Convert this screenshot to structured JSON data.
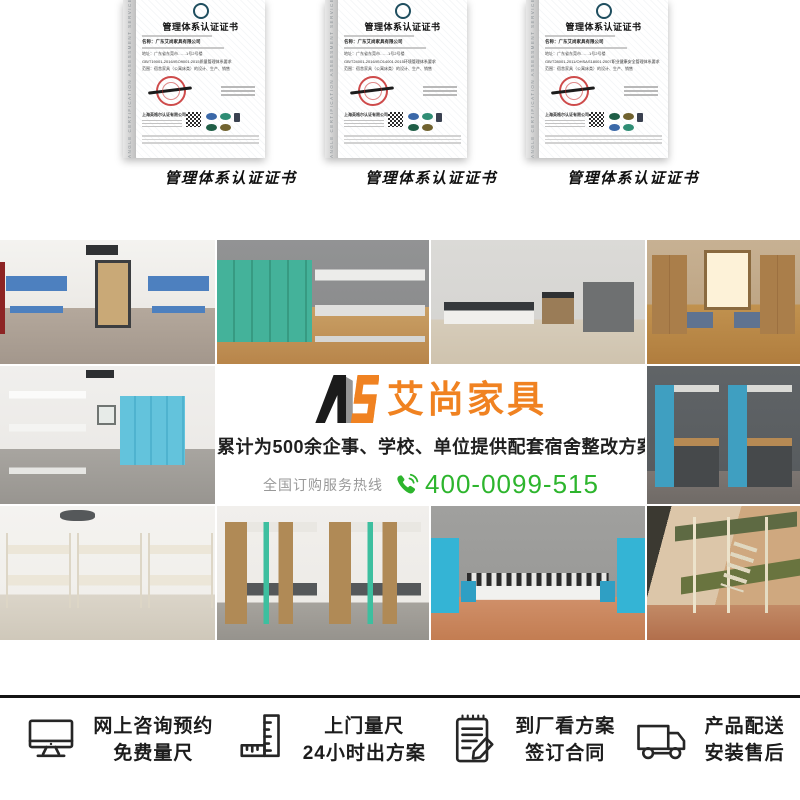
{
  "certificates": {
    "watermark": "ANGLE CERTIFICATION ASSESSMENT SERVICES",
    "cert": {
      "title": "管理体系认证证书",
      "company": "名称：广东艾尚家具有限公司",
      "address": "地址：广东省东莞市……1号2号楼",
      "scope": "范围：宿舍家具（公寓床类）的设计、生产、销售",
      "issuer": "上海英格尔认证有限公司"
    },
    "items": [
      {
        "caption": "管理体系认证证书",
        "standard": "GB/T19001-2016/ISO9001:2015质量管理体系要求"
      },
      {
        "caption": "管理体系认证证书",
        "standard": "GB/T24001-2016/ISO14001:2015环境管理体系要求"
      },
      {
        "caption": "管理体系认证证书",
        "standard": "GB/T28001-2011/OHSAS18001:2007职业健康安全管理体系要求"
      }
    ]
  },
  "banner": {
    "logo_mark": "AS",
    "logo_text": "艾尚家具",
    "subtitle": "累计为500余企事、学校、单位提供配套宿舍整改方案",
    "hotline_label": "全国订购服务热线",
    "phone": "400-0099-515",
    "colors": {
      "orange": "#f08221",
      "green": "#2db52d",
      "black": "#1a1a1a"
    }
  },
  "features": [
    {
      "icon": "monitor-icon",
      "line1": "网上咨询预约",
      "line2": "免费量尺"
    },
    {
      "icon": "ruler-icon",
      "line1": "上门量尺",
      "line2": "24小时出方案"
    },
    {
      "icon": "contract-icon",
      "line1": "到厂看方案",
      "line2": "签订合同"
    },
    {
      "icon": "truck-icon",
      "line1": "产品配送",
      "line2": "安装售后"
    }
  ]
}
